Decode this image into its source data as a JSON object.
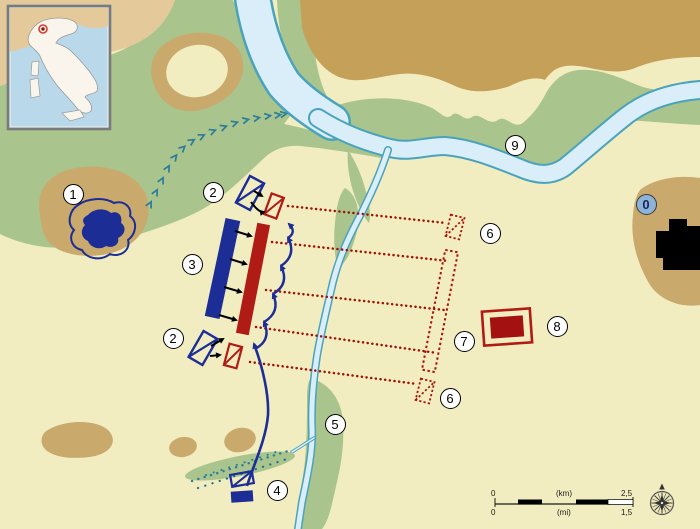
{
  "map_type": "historical-battle-map",
  "markers": [
    {
      "label": "1"
    },
    {
      "label": "2"
    },
    {
      "label": "3"
    },
    {
      "label": "2"
    },
    {
      "label": "4"
    },
    {
      "label": "5"
    },
    {
      "label": "6"
    },
    {
      "label": "7"
    },
    {
      "label": "8"
    },
    {
      "label": "6"
    },
    {
      "label": "9"
    },
    {
      "label": "0"
    }
  ],
  "scale_bar": {
    "km_min": "0",
    "km_unit": "(km)",
    "km_max": "2,5",
    "mi_min": "0",
    "mi_unit": "(mi)",
    "mi_max": "1,5"
  },
  "icons": {
    "compass": "compass-rose",
    "inset_marker": "red-location-dot"
  },
  "colors": {
    "background": "#f2edc0",
    "vegetation": "#a9c48d",
    "hills": "#c9a96c",
    "highland_band": "#c5a058",
    "corner_land": "#e4c99b",
    "river_fill": "#d9eef8",
    "river_edge": "#4aa3bc",
    "blue_army": "#1c2d96",
    "red_army": "#b01b15",
    "red_solid_unit": "#a31111",
    "red_movement_dots": "#a01208",
    "trail_chevrons": "#2b7d99",
    "city": "#000000",
    "marker_zero_fill": "#8fb2d9",
    "inset_sea": "#b9d9ea",
    "inset_land": "#f9f5ec"
  }
}
